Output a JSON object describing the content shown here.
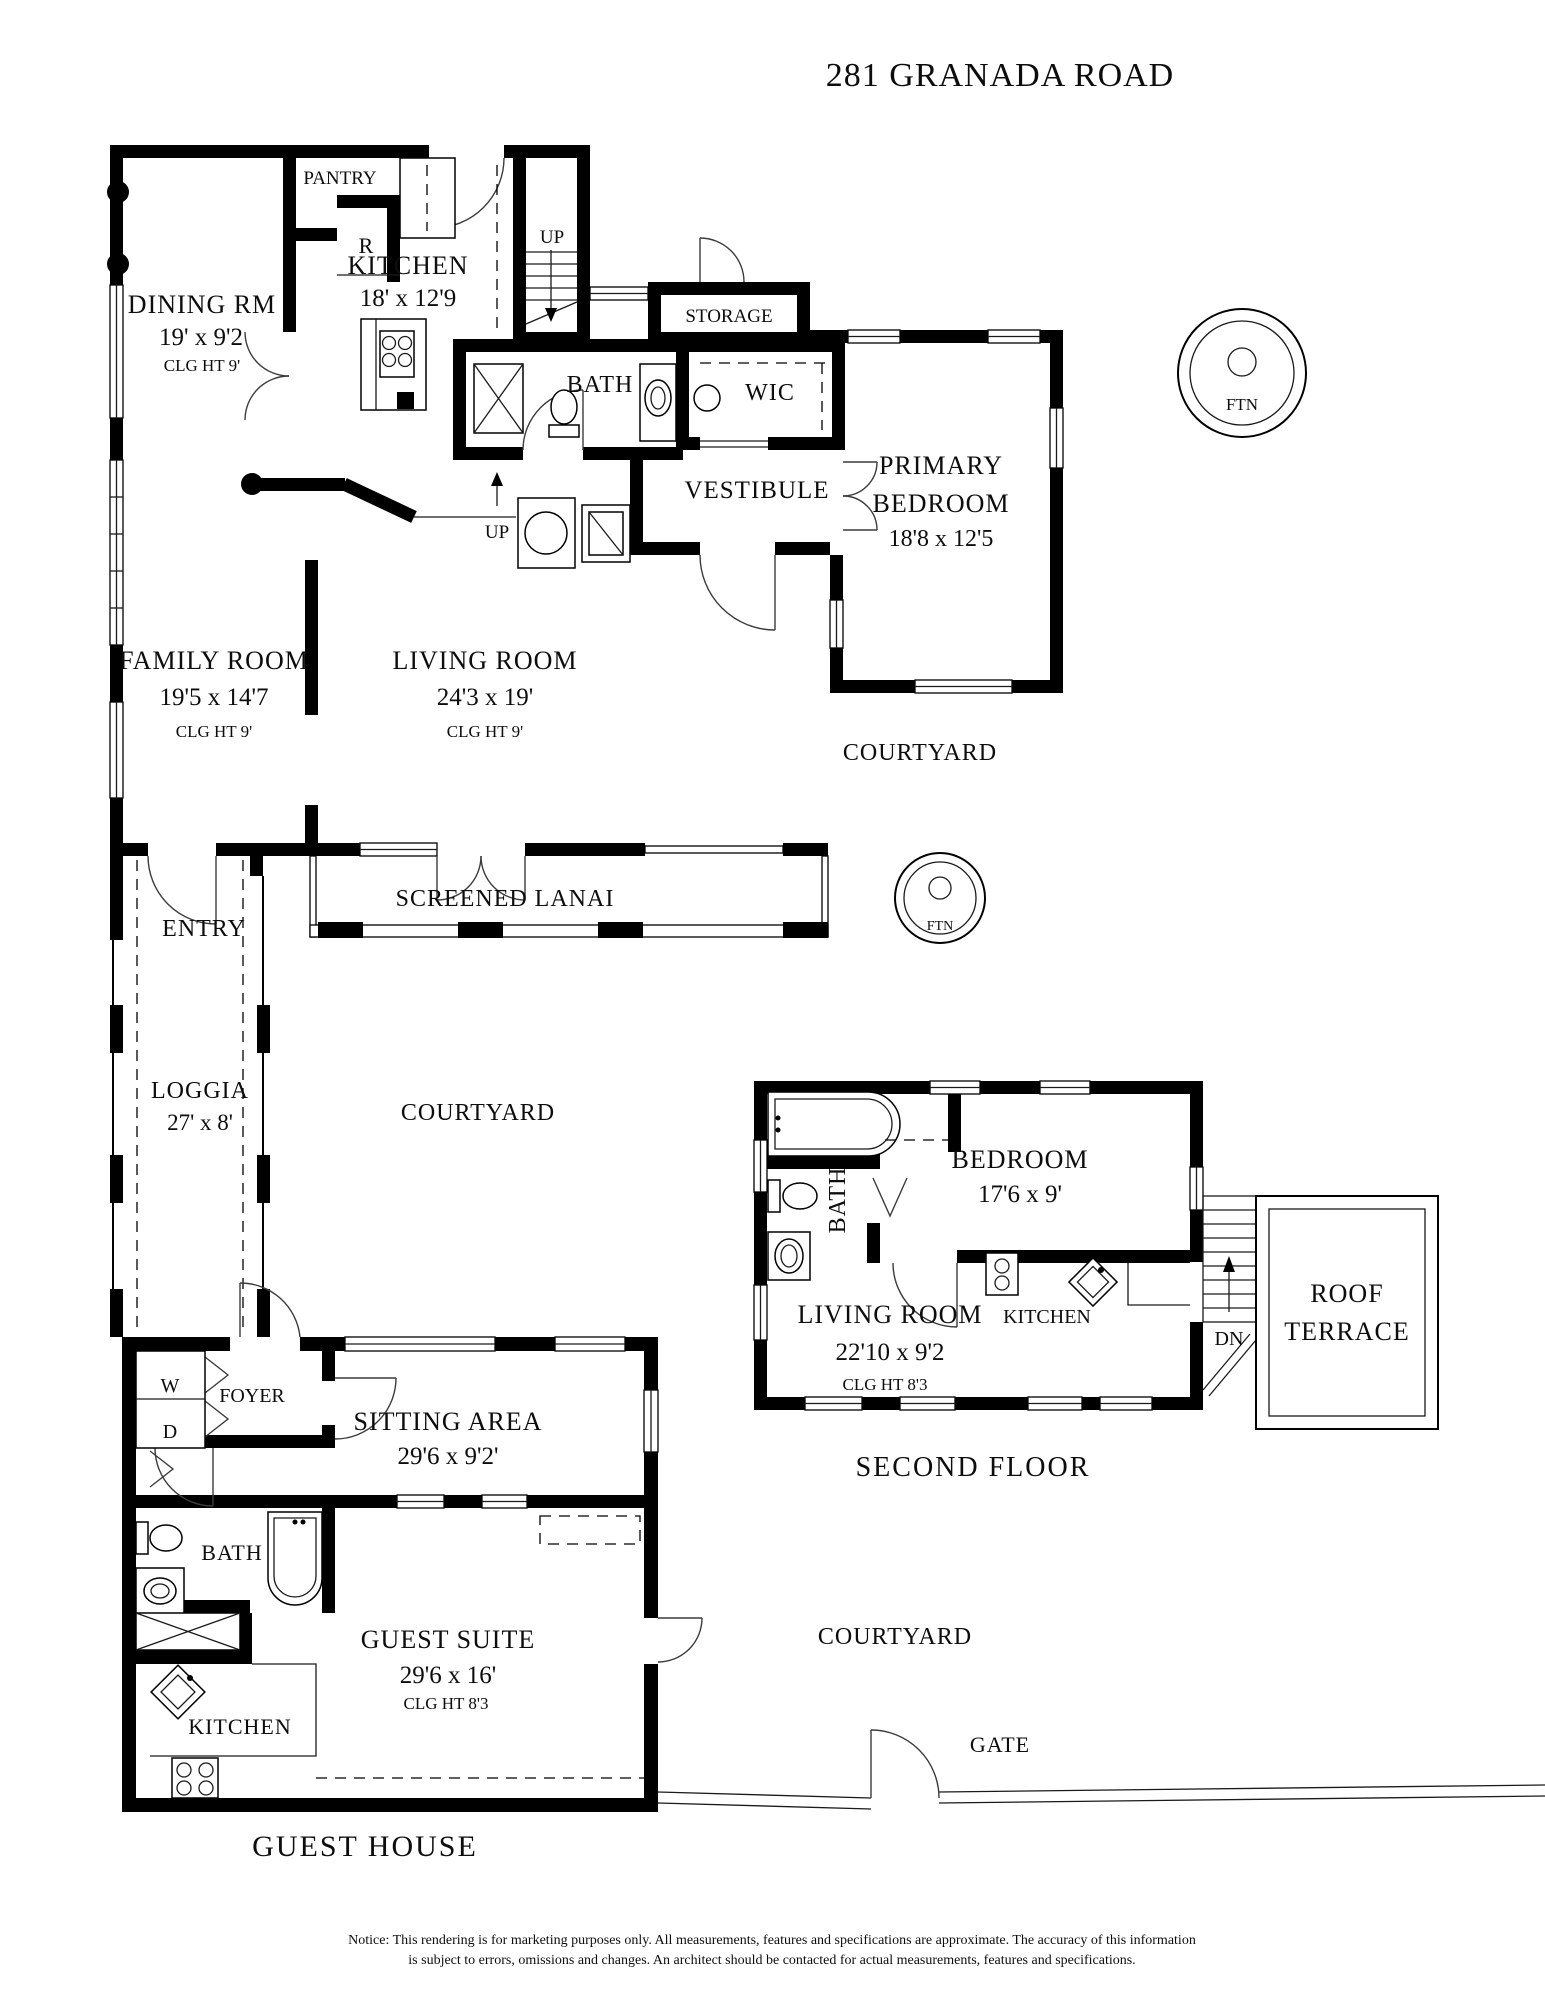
{
  "title": "281 GRANADA ROAD",
  "main_floor": {
    "dining": {
      "name": "DINING RM",
      "dims": "19' x 9'2",
      "clg": "CLG HT 9'"
    },
    "kitchen": {
      "name": "KITCHEN",
      "dims": "18' x 12'9"
    },
    "pantry": {
      "name": "PANTRY"
    },
    "fridge": {
      "abbr": "R"
    },
    "stairs_top": {
      "label": "UP"
    },
    "stairs_mid": {
      "label": "UP"
    },
    "storage": {
      "name": "STORAGE"
    },
    "bath": {
      "name": "BATH"
    },
    "wic": {
      "name": "WIC"
    },
    "vestibule": {
      "name": "VESTIBULE"
    },
    "primary_bedroom": {
      "name_line1": "PRIMARY",
      "name_line2": "BEDROOM",
      "dims": "18'8 x 12'5"
    },
    "family_room": {
      "name": "FAMILY ROOM",
      "dims": "19'5 x 14'7",
      "clg": "CLG HT 9'"
    },
    "living_room": {
      "name": "LIVING ROOM",
      "dims": "24'3 x 19'",
      "clg": "CLG HT 9'"
    },
    "screened_lanai": {
      "name": "SCREENED LANAI"
    },
    "entry": {
      "name": "ENTRY"
    },
    "loggia": {
      "name": "LOGGIA",
      "dims": "27' x 8'"
    }
  },
  "site": {
    "courtyard_upper": "COURTYARD",
    "courtyard_middle": "COURTYARD",
    "courtyard_lower": "COURTYARD",
    "fountain_upper": "FTN",
    "fountain_lower": "FTN",
    "gate": "GATE"
  },
  "second_floor": {
    "caption": "SECOND FLOOR",
    "bath": {
      "name": "BATH"
    },
    "bedroom": {
      "name": "BEDROOM",
      "dims": "17'6 x 9'"
    },
    "living_room": {
      "name": "LIVING ROOM",
      "dims": "22'10 x 9'2",
      "clg": "CLG HT 8'3"
    },
    "kitchen": {
      "name": "KITCHEN"
    },
    "stairs_down": {
      "label": "DN"
    },
    "roof_terrace": {
      "name_line1": "ROOF",
      "name_line2": "TERRACE"
    }
  },
  "guest_house": {
    "caption": "GUEST HOUSE",
    "washer": "W",
    "dryer": "D",
    "foyer": {
      "name": "FOYER"
    },
    "sitting_area": {
      "name": "SITTING AREA",
      "dims": "29'6 x 9'2'"
    },
    "bath": {
      "name": "BATH"
    },
    "guest_suite": {
      "name": "GUEST SUITE",
      "dims": "29'6 x 16'",
      "clg": "CLG HT 8'3"
    },
    "kitchen": {
      "name": "KITCHEN"
    }
  },
  "notice": {
    "line1": "Notice: This rendering is for marketing purposes only. All measurements, features and specifications are approximate. The accuracy of this information",
    "line2": "is subject to errors, omissions and changes. An architect should be contacted for actual measurements, features and specifications."
  }
}
